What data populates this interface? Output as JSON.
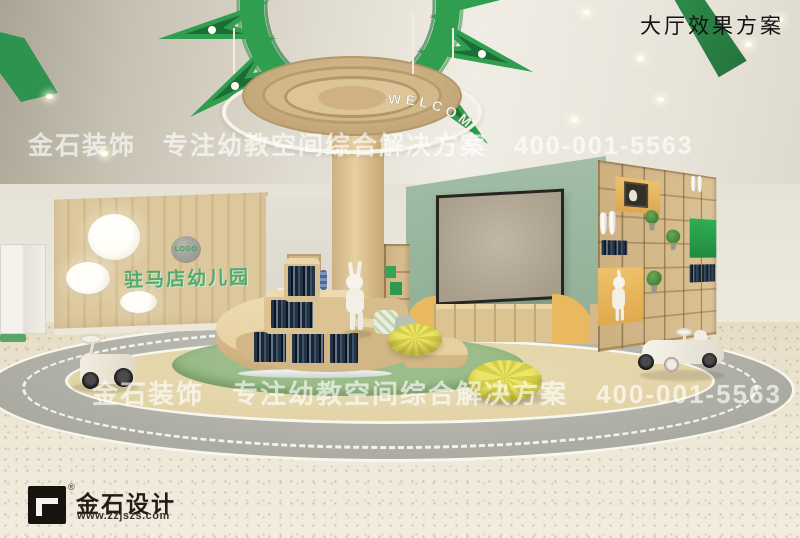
{
  "page": {
    "title": "大厅效果方案"
  },
  "watermark": {
    "text": "金石装饰　专注幼教空间综合解决方案　400-001-5563"
  },
  "scene": {
    "welcome_ring_text": "WELCOM",
    "wall_logo_badge": "LOGO",
    "wall_name": "驻马店幼儿园"
  },
  "branding": {
    "registered": "®",
    "company": "金石设计",
    "website": "www.zzjszs.com"
  },
  "colors": {
    "accent_green": "#2f9e4f",
    "sage_wall": "#9cb7a0",
    "wood": "#d8c196",
    "niche_yellow": "#e8b55c",
    "niche_green": "#2aa24b",
    "carpet_green": "#8fb580",
    "road_gray": "#b2b2aa",
    "pouf_yellow": "#e6df5d"
  }
}
